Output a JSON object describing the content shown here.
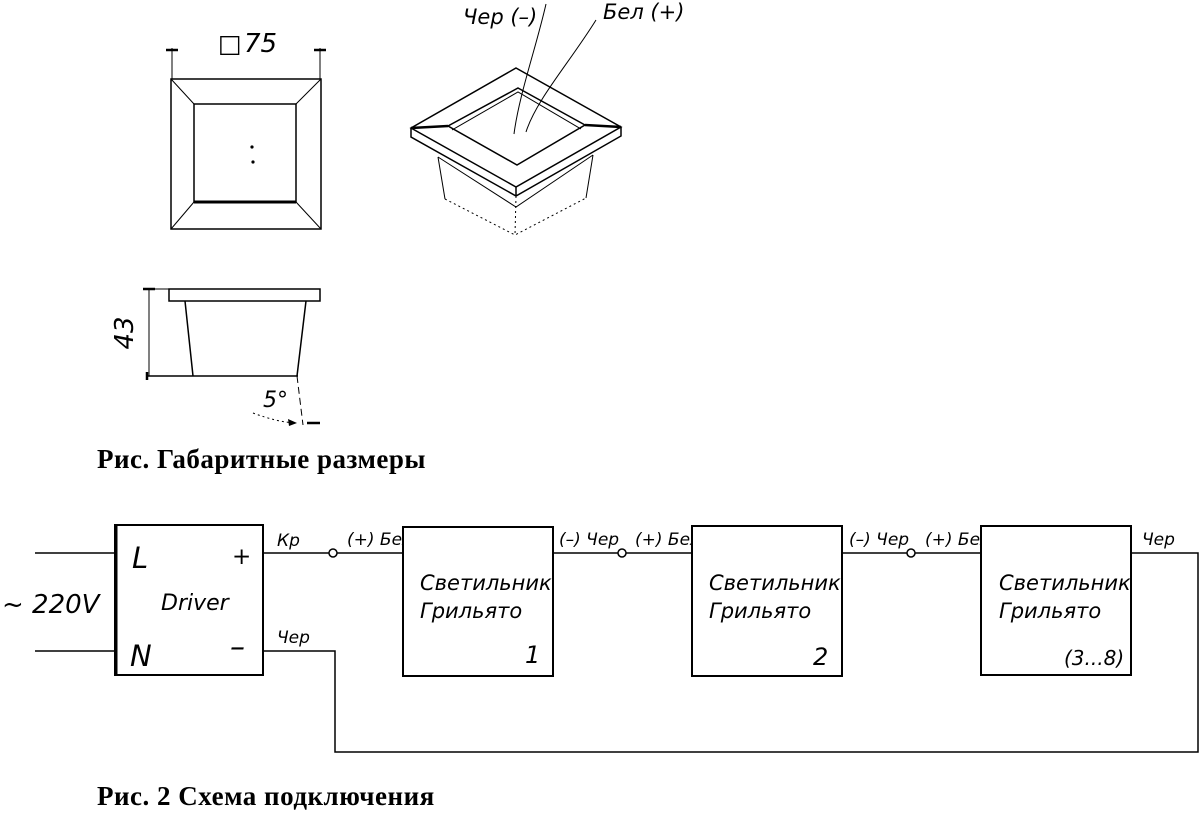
{
  "figure1": {
    "caption": "Рис. Габаритные размеры",
    "top_view": {
      "square_symbol": "□",
      "width_label": "75"
    },
    "iso_view": {
      "black_wire_label": "Чер (–)",
      "white_wire_label": "Бел (+)"
    },
    "side_view": {
      "height_label": "43",
      "angle_label": "5°"
    }
  },
  "figure2": {
    "caption": "Рис. 2 Схема подключения",
    "mains_label": "~ 220V",
    "driver": {
      "title": "Driver",
      "live": "L",
      "neutral": "N",
      "plus": "+",
      "minus": "–",
      "plus_wire": "Кр",
      "minus_wire": "Чер"
    },
    "wire_labels": {
      "seg1_plus": "(+) Бел",
      "seg2_minus": "(–) Чер",
      "seg2_plus": "(+) Бел",
      "seg3_minus": "(–) Чер",
      "seg3_plus": "(+) Бел",
      "tail": "Чер"
    },
    "luminaires": [
      {
        "title_line1": "Светильник",
        "title_line2": "Грильято",
        "index": "1"
      },
      {
        "title_line1": "Светильник",
        "title_line2": "Грильято",
        "index": "2"
      },
      {
        "title_line1": "Светильник",
        "title_line2": "Грильято",
        "index": "(3...8)"
      }
    ]
  }
}
